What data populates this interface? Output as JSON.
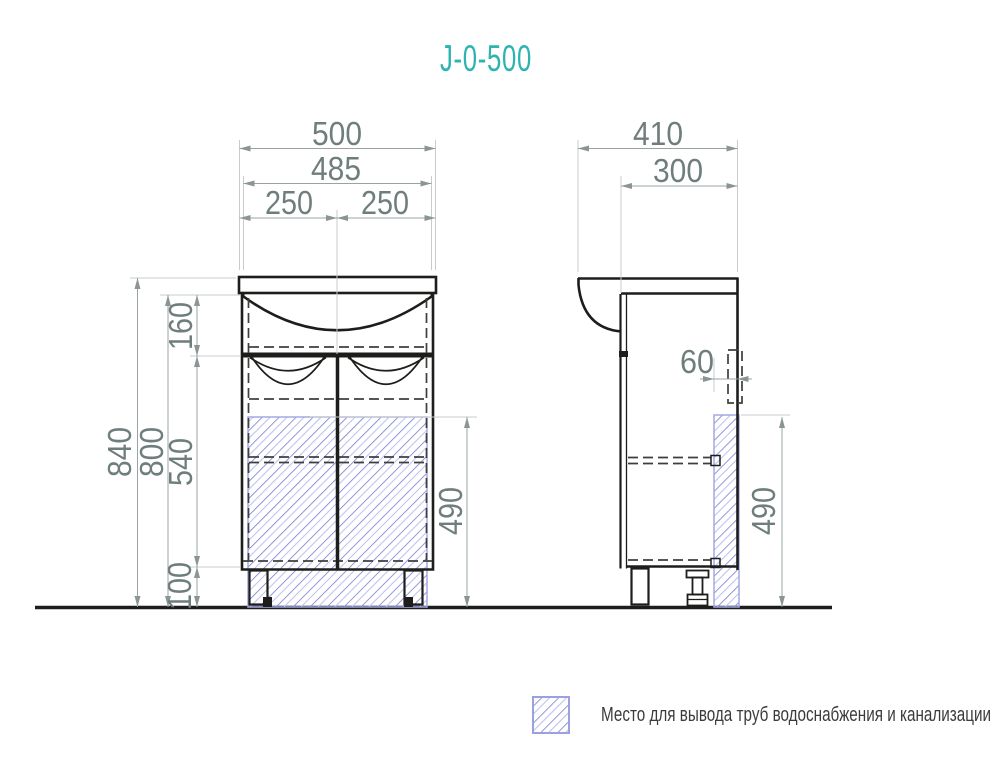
{
  "title": "J-0-500",
  "dimensions": {
    "front": {
      "overall_width": "500",
      "inner_width": "485",
      "left_half": "250",
      "right_half": "250",
      "total_height": "840",
      "body_height": "800",
      "sink_section_height": "160",
      "door_section_height": "540",
      "leg_height": "100",
      "pipe_zone_height": "490"
    },
    "side": {
      "overall_depth": "410",
      "inner_depth": "300",
      "pipe_zone_offset": "60",
      "pipe_zone_height": "490"
    }
  },
  "legend": {
    "label": "Место для вывода труб водоснабжения и канализации"
  },
  "colors": {
    "title": "#2cb5b0",
    "outline": "#1d1d1b",
    "dimension_text": "#6f7e7d",
    "hatch_line": "#767bd4",
    "hatch_border": "#a3a8e4"
  }
}
